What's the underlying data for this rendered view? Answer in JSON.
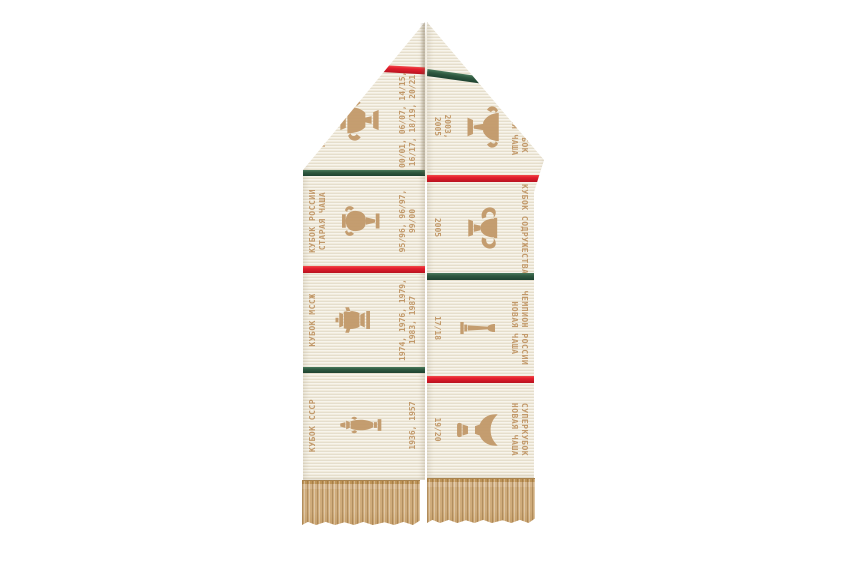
{
  "colors": {
    "background": "#ffffff",
    "fabric": "#f1ebdc",
    "motif_tan": "#c2996a",
    "stripe_red": "#e41e2d",
    "stripe_green": "#2f5940",
    "fringe_tan": "#cfad7e"
  },
  "scarf": {
    "left_panel": {
      "top_stripe_color": "red",
      "sections": [
        {
          "trophy_icon": "russian-cup-new-trophy",
          "title_line1": "КУБОК РОССИИ",
          "title_line2": "НОВАЯ ЧАША",
          "dates_line1": "00/01, 06/07, 14/15,",
          "dates_line2": "16/17, 18/19, 20/21",
          "divider_below": "green"
        },
        {
          "trophy_icon": "russian-cup-old-trophy",
          "title_line1": "КУБОК РОССИИ",
          "title_line2": "СТАРАЯ ЧАША",
          "dates_line1": "95/96, 96/97,",
          "dates_line2": "99/00",
          "divider_below": "red"
        },
        {
          "trophy_icon": "msszh-cup-trophy",
          "title_line1": "КУБОК МССЖ",
          "title_line2": "",
          "dates_line1": "1974, 1976, 1979,",
          "dates_line2": "1983, 1987",
          "divider_below": "green"
        },
        {
          "trophy_icon": "ussr-cup-trophy",
          "title_line1": "КУБОК СССР",
          "title_line2": "",
          "dates_line1": "1936, 1957",
          "dates_line2": "",
          "divider_below": null
        }
      ]
    },
    "right_panel": {
      "top_stripe_color": "green",
      "sections": [
        {
          "trophy_icon": "supercup-old-trophy",
          "title_line1": "СУПЕРКУБОК",
          "title_line2": "СТАРАЯ ЧАША",
          "dates_line1": "2003,",
          "dates_line2": "2005",
          "divider_below": "red"
        },
        {
          "trophy_icon": "commonwealth-cup-trophy",
          "title_line1": "КУБОК СОДРУЖЕСТВА",
          "title_line2": "",
          "dates_line1": "2005",
          "dates_line2": "",
          "divider_below": "green"
        },
        {
          "trophy_icon": "russian-champion-trophy",
          "title_line1": "ЧЕМПИОН РОССИИ",
          "title_line2": "НОВАЯ ЧАША",
          "dates_line1": "17/18",
          "dates_line2": "",
          "divider_below": "red"
        },
        {
          "trophy_icon": "supercup-new-trophy",
          "title_line1": "СУПЕРКУБОК",
          "title_line2": "НОВАЯ ЧАША",
          "dates_line1": "19/20",
          "dates_line2": "",
          "divider_below": null
        }
      ]
    }
  }
}
